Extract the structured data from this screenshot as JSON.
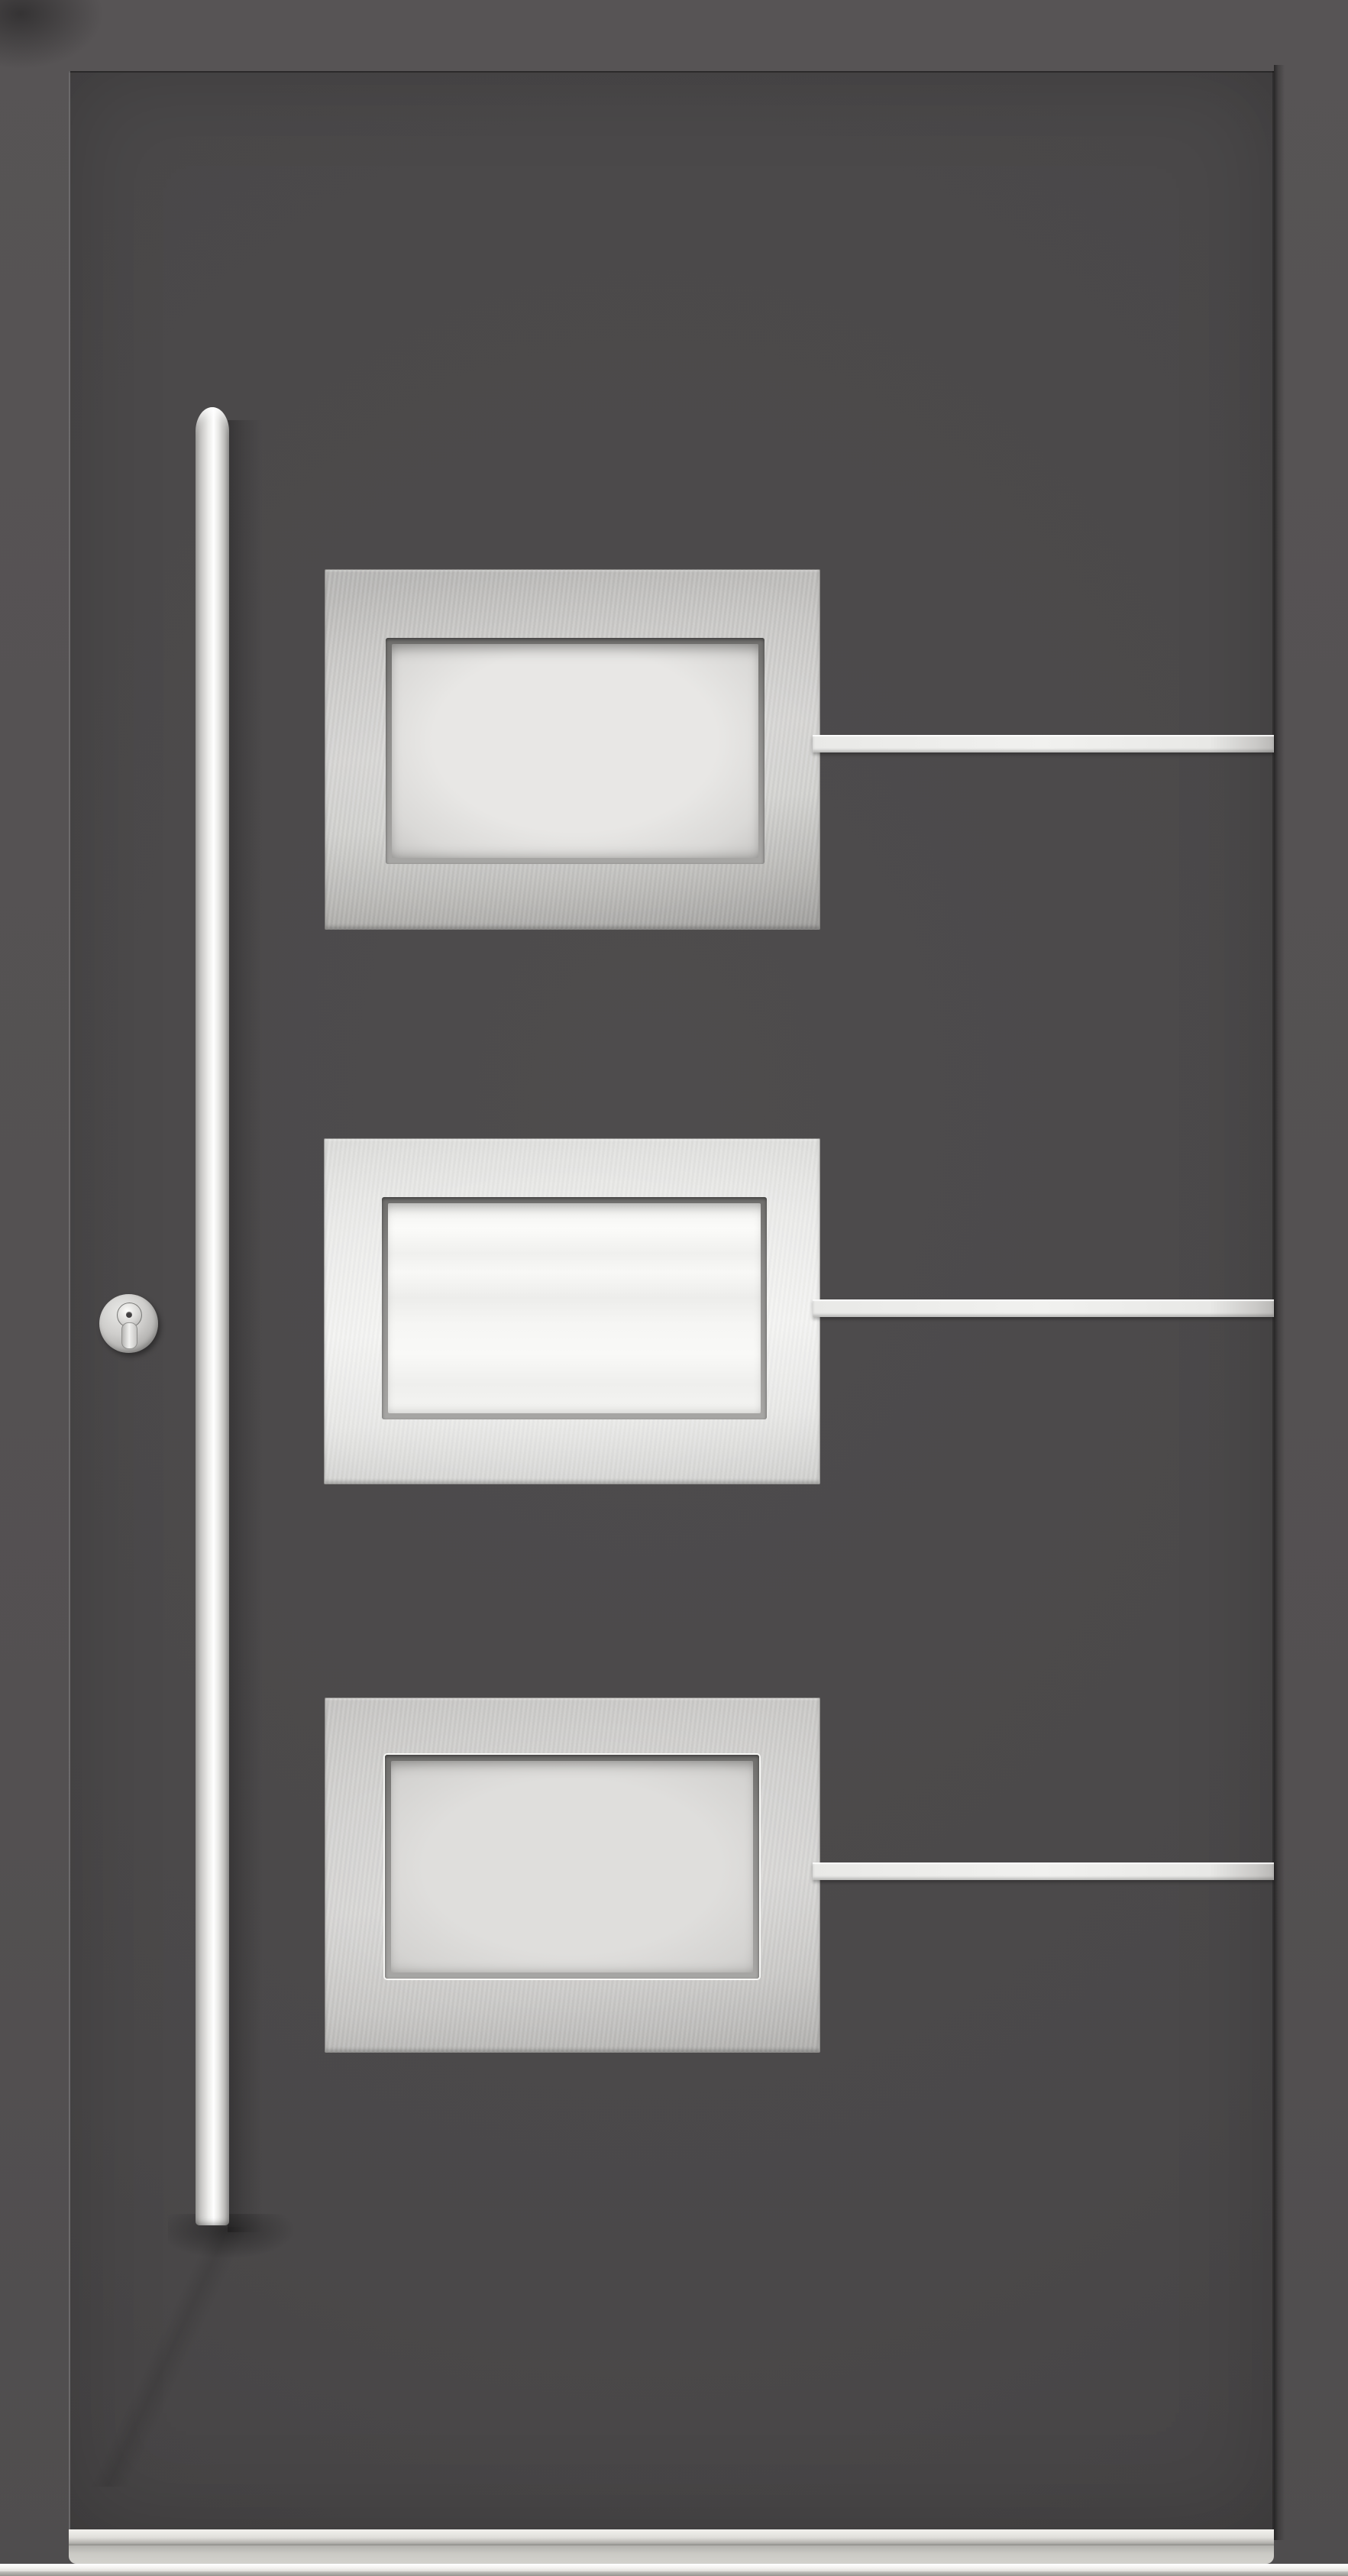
{
  "scene": {
    "type": "product-photo",
    "subject": "modern aluminium entrance door, anthracite grey",
    "door": {
      "leaf_finish": "anthracite grey, smooth",
      "frame": "matching grey outer frame",
      "glazing_panels": [
        {
          "position": "top",
          "style": "brushed stainless plate with recessed frosted glass window"
        },
        {
          "position": "middle",
          "style": "bright stainless plate with recessed white frosted glass window"
        },
        {
          "position": "bottom",
          "style": "brushed stainless plate with recessed frosted glass window, thin white glazing outline"
        }
      ],
      "decor_strips": {
        "count": 3,
        "description": "horizontal stainless strips from each panel's right edge to the door edge, vertically centered on each panel"
      },
      "handle": "full-length vertical stainless steel bar pull handle, domed top cap, left side",
      "lock": "round stainless escutcheon with euro profile cylinder and keyway, left side at mid height",
      "threshold": "low aluminium threshold sill at bottom"
    },
    "colors": {
      "frame": "#575455",
      "leaf": "#4e4c4d",
      "leaf_edge": "#403e3f",
      "steel_light": "#ececea",
      "steel_mid": "#c2c1bf",
      "steel_dark": "#979694",
      "glass_frosted": "#e8e7e5",
      "glass_bright": "#f6f6f4",
      "glass_gray": "#dfdedc",
      "strip": "#e9e9e7",
      "handle_core": "#ffffff",
      "handle_edge": "#9a9997",
      "threshold_face": "#cbcac5",
      "sill_white": "#f2f1ed",
      "sill_base": "#95948f"
    }
  }
}
